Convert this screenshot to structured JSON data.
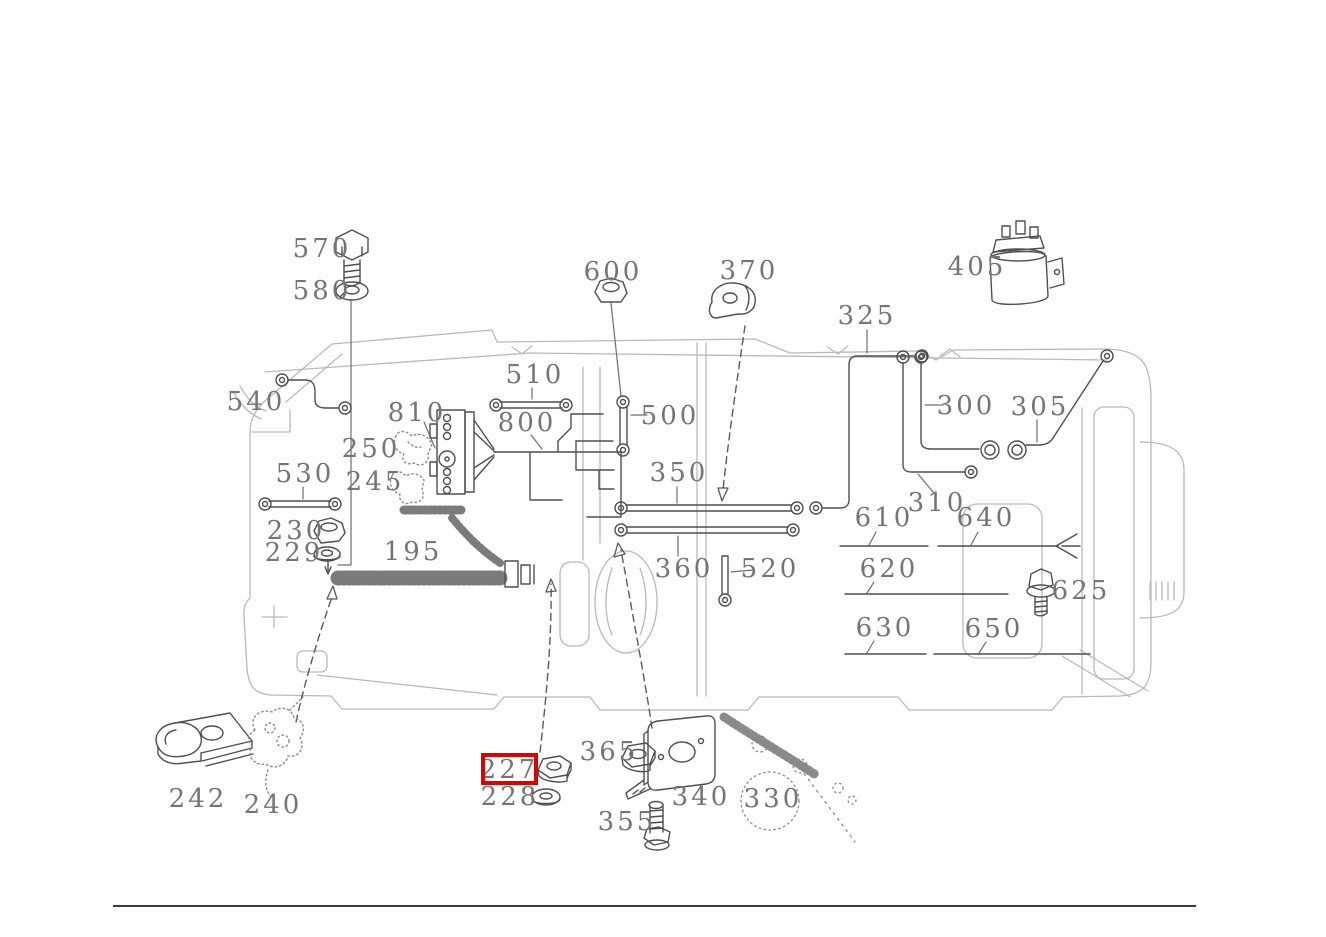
{
  "diagram": {
    "kind": "vehicle-chassis-wiring-harness-parts-diagram",
    "colors": {
      "chassis": "#b9b9b9",
      "parts": "#4f4f4f",
      "labels": "#757575",
      "highlight": "#e00000",
      "divider": "#3c3c3c"
    },
    "highlight": {
      "label": "227",
      "x": 481,
      "y": 753,
      "width": 57,
      "height": 32,
      "color": "#e00000"
    },
    "footer_divider": {
      "x": 113,
      "y": 905,
      "width": 1083
    },
    "callouts": [
      {
        "label": "570",
        "icon": "bolt-icon",
        "x": 322,
        "y": 249
      },
      {
        "label": "580",
        "icon": "washer-icon",
        "x": 322,
        "y": 291
      },
      {
        "label": "600",
        "icon": "nut-icon",
        "x": 613,
        "y": 272
      },
      {
        "label": "370",
        "icon": "clamp-icon",
        "x": 749,
        "y": 271
      },
      {
        "label": "405",
        "icon": "solenoid-icon",
        "x": 977,
        "y": 267
      },
      {
        "label": "325",
        "icon": "cable-icon",
        "x": 867,
        "y": 316
      },
      {
        "label": "540",
        "icon": "cable-icon",
        "x": 256,
        "y": 402
      },
      {
        "label": "510",
        "icon": "cable-icon",
        "x": 535,
        "y": 375
      },
      {
        "label": "810",
        "icon": "connector-block-icon",
        "x": 417,
        "y": 413
      },
      {
        "label": "800",
        "icon": "harness-icon",
        "x": 527,
        "y": 423
      },
      {
        "label": "500",
        "icon": "cable-icon",
        "x": 670,
        "y": 416
      },
      {
        "label": "300",
        "icon": "cable-icon",
        "x": 966,
        "y": 406
      },
      {
        "label": "305",
        "icon": "cable-icon",
        "x": 1040,
        "y": 407
      },
      {
        "label": "250",
        "icon": "clip-icon",
        "x": 371,
        "y": 449
      },
      {
        "label": "530",
        "icon": "cable-icon",
        "x": 305,
        "y": 474
      },
      {
        "label": "350",
        "icon": "cable-icon",
        "x": 679,
        "y": 473
      },
      {
        "label": "245",
        "icon": "clip-icon",
        "x": 375,
        "y": 482
      },
      {
        "label": "310",
        "icon": "cable-icon",
        "x": 937,
        "y": 503
      },
      {
        "label": "610",
        "icon": "cable-line-icon",
        "x": 884,
        "y": 518
      },
      {
        "label": "640",
        "icon": "cable-line-icon",
        "x": 986,
        "y": 518
      },
      {
        "label": "230",
        "icon": "nut-icon",
        "x": 296,
        "y": 531
      },
      {
        "label": "195",
        "icon": "harness-icon",
        "x": 413,
        "y": 552
      },
      {
        "label": "229",
        "icon": "washer-icon",
        "x": 294,
        "y": 553
      },
      {
        "label": "360",
        "icon": "cable-icon",
        "x": 684,
        "y": 569
      },
      {
        "label": "520",
        "icon": "cable-icon",
        "x": 770,
        "y": 569
      },
      {
        "label": "620",
        "icon": "cable-line-icon",
        "x": 889,
        "y": 569
      },
      {
        "label": "625",
        "icon": "bolt-icon",
        "x": 1081,
        "y": 591
      },
      {
        "label": "630",
        "icon": "cable-line-icon",
        "x": 885,
        "y": 628
      },
      {
        "label": "650",
        "icon": "cable-line-icon",
        "x": 994,
        "y": 629
      },
      {
        "label": "365",
        "icon": "nut-icon",
        "x": 609,
        "y": 752
      },
      {
        "label": "227",
        "icon": "nut-icon",
        "x": 509,
        "y": 770
      },
      {
        "label": "228",
        "icon": "washer-icon",
        "x": 510,
        "y": 797
      },
      {
        "label": "330",
        "icon": "harness-icon",
        "x": 773,
        "y": 799
      },
      {
        "label": "340",
        "icon": "bracket-icon",
        "x": 701,
        "y": 797
      },
      {
        "label": "242",
        "icon": "clamp-icon",
        "x": 198,
        "y": 799
      },
      {
        "label": "240",
        "icon": "grommet-icon",
        "x": 273,
        "y": 805
      },
      {
        "label": "355",
        "icon": "bolt-icon",
        "x": 627,
        "y": 822
      }
    ]
  }
}
